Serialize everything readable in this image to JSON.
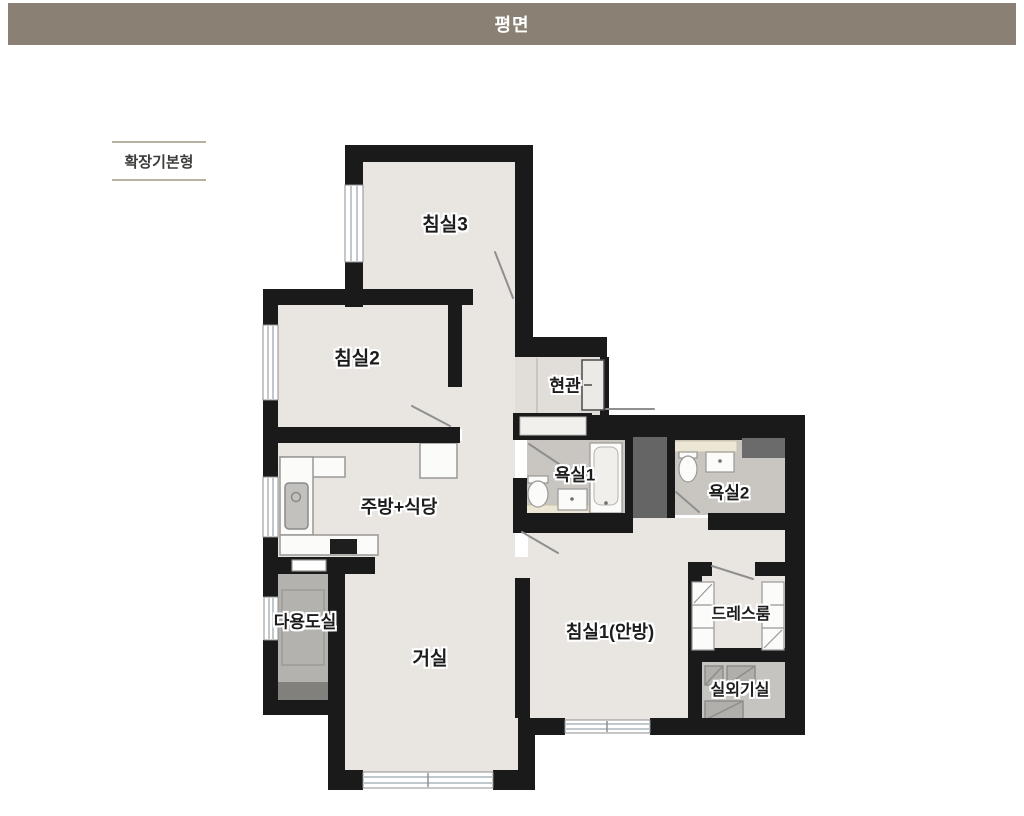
{
  "header": {
    "title": "평면"
  },
  "variant": {
    "label": "확장기본형"
  },
  "rooms": {
    "bedroom3": {
      "name": "침실3"
    },
    "bedroom2": {
      "name": "침실2"
    },
    "entrance": {
      "name": "현관"
    },
    "bath1": {
      "name": "욕실1"
    },
    "bath2": {
      "name": "욕실2"
    },
    "kitchen_dining": {
      "name": "주방+식당"
    },
    "utility": {
      "name": "다용도실"
    },
    "living": {
      "name": "거실"
    },
    "bedroom1_master": {
      "name": "침실1(안방)"
    },
    "dressroom": {
      "name": "드레스룸"
    },
    "ac_room": {
      "name": "실외기실"
    }
  },
  "colors": {
    "header_bg": "#8a8174",
    "wall": "#1a1a1a",
    "floor_main": "#e9e6e1",
    "floor_entrance": "#e1ded9",
    "floor_bath": "#c9c6c1",
    "floor_utility": "#b4b2ae",
    "floor_ac": "#c6c4c0",
    "duct_dark": "#656565",
    "shelf_cream": "#ece6d4"
  }
}
